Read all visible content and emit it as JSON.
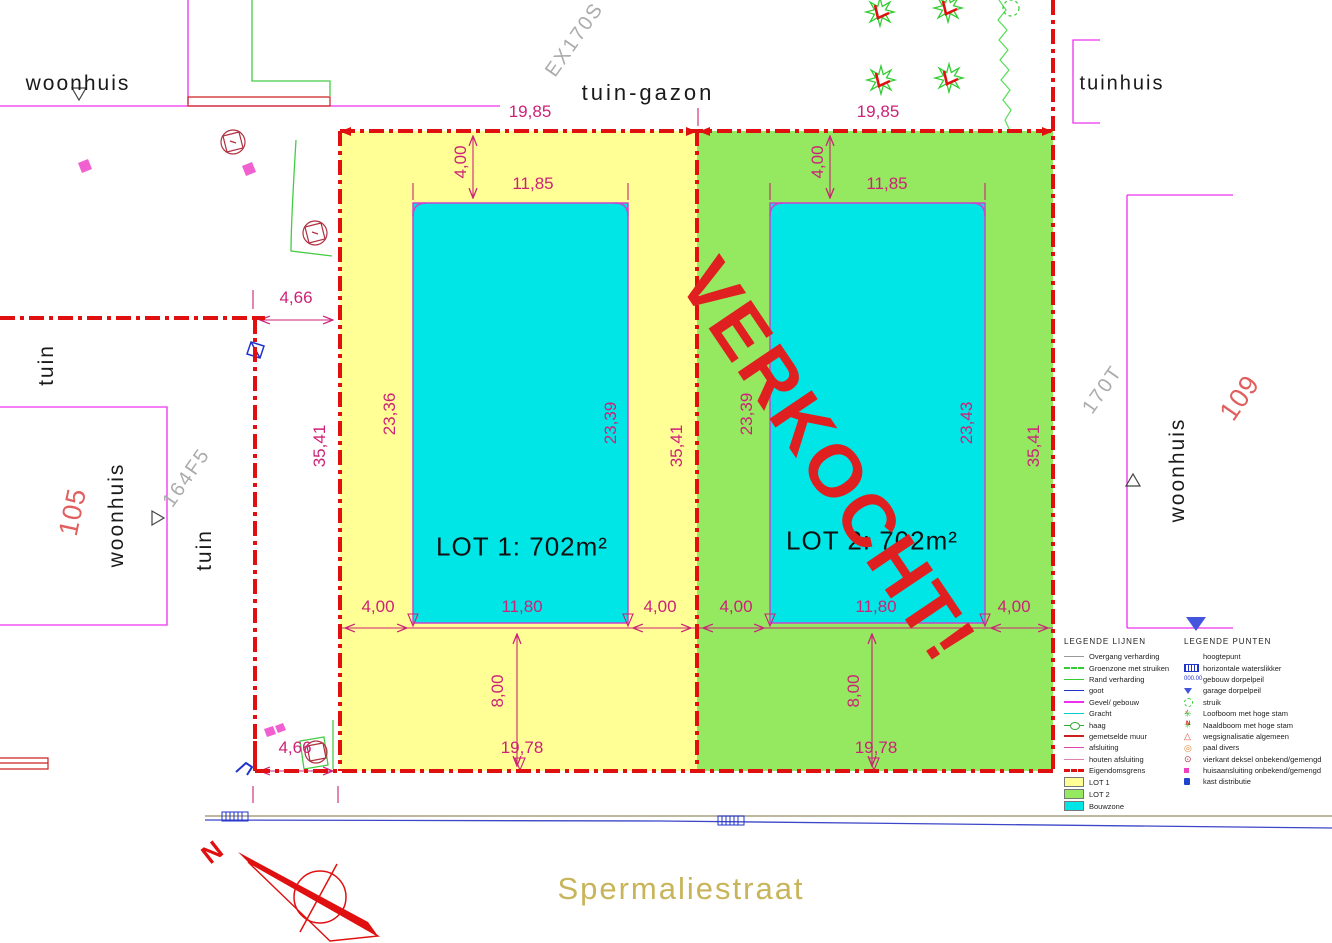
{
  "labels": {
    "woonhuis_tl": "woonhuis",
    "tuin_gazon": "tuin-gazon",
    "tuinhuis": "tuinhuis",
    "ex170s": "EX170S",
    "tuin_left_upper": "tuin",
    "tuin_left_lower": "tuin",
    "parcel_105": "105",
    "woonhuis_left": "woonhuis",
    "parcel_164f5": "164F5",
    "parcel_170t": "170T",
    "parcel_109": "109",
    "woonhuis_right": "woonhuis"
  },
  "lots": {
    "lot1": "LOT 1: 702m²",
    "lot2": "LOT 2: 702m²",
    "verkocht": "VERKOCHT!"
  },
  "dims": {
    "d19_85_l": "19,85",
    "d19_85_r": "19,85",
    "d4_00_t1": "4,00",
    "d4_00_t2": "4,00",
    "d11_85_l": "11,85",
    "d11_85_r": "11,85",
    "d23_36": "23,36",
    "d23_39_a": "23,39",
    "d23_39_b": "23,39",
    "d23_43": "23,43",
    "d35_41_a": "35,41",
    "d35_41_b": "35,41",
    "d35_41_c": "35,41",
    "d4_66_t": "4,66",
    "d4_66_b": "4,66",
    "d4_00_b1": "4,00",
    "d11_80_l": "11,80",
    "d4_00_b2": "4,00",
    "d4_00_b3": "4,00",
    "d11_80_r": "11,80",
    "d4_00_b4": "4,00",
    "d8_00_l": "8,00",
    "d8_00_r": "8,00",
    "d19_78_l": "19,78",
    "d19_78_r": "19,78"
  },
  "street": {
    "name": "Spermaliestraat"
  },
  "compass": {
    "north": "N"
  },
  "legend_lines": {
    "title": "LEGENDE LIJNEN",
    "items": [
      "Overgang verharding",
      "Groenzone met struiken",
      "Rand verharding",
      "goot",
      "Gevel/ gebouw",
      "Gracht",
      "haag",
      "gemetselde muur",
      "afsluiting",
      "houten afsluiting",
      "Eigendomsgrens",
      "LOT 1",
      "LOT 2",
      "Bouwzone"
    ]
  },
  "legend_punten": {
    "title": "LEGENDE PUNTEN",
    "peil": "000.00",
    "items": [
      "hoogtepunt",
      "horizontale waterslikker",
      "gebouw dorpelpeil",
      "garage dorpelpeil",
      "struik",
      "Loofboom met hoge stam",
      "Naaldboom met hoge stam",
      "wegsignalisatie algemeen",
      "paal divers",
      "vierkant deksel onbekend/gemengd",
      "huisaansluiting onbekend/gemengd",
      "kast distributie"
    ]
  },
  "colors": {
    "property_line": "#E01010",
    "dimension": "#CC2277",
    "lot1_fill": "#FFFF96",
    "lot2_fill": "#94E961",
    "bouwzone_fill": "#00E6E6",
    "building_line": "#EE30EE",
    "verkocht": "#E02020",
    "street_name": "#C8B45A"
  }
}
